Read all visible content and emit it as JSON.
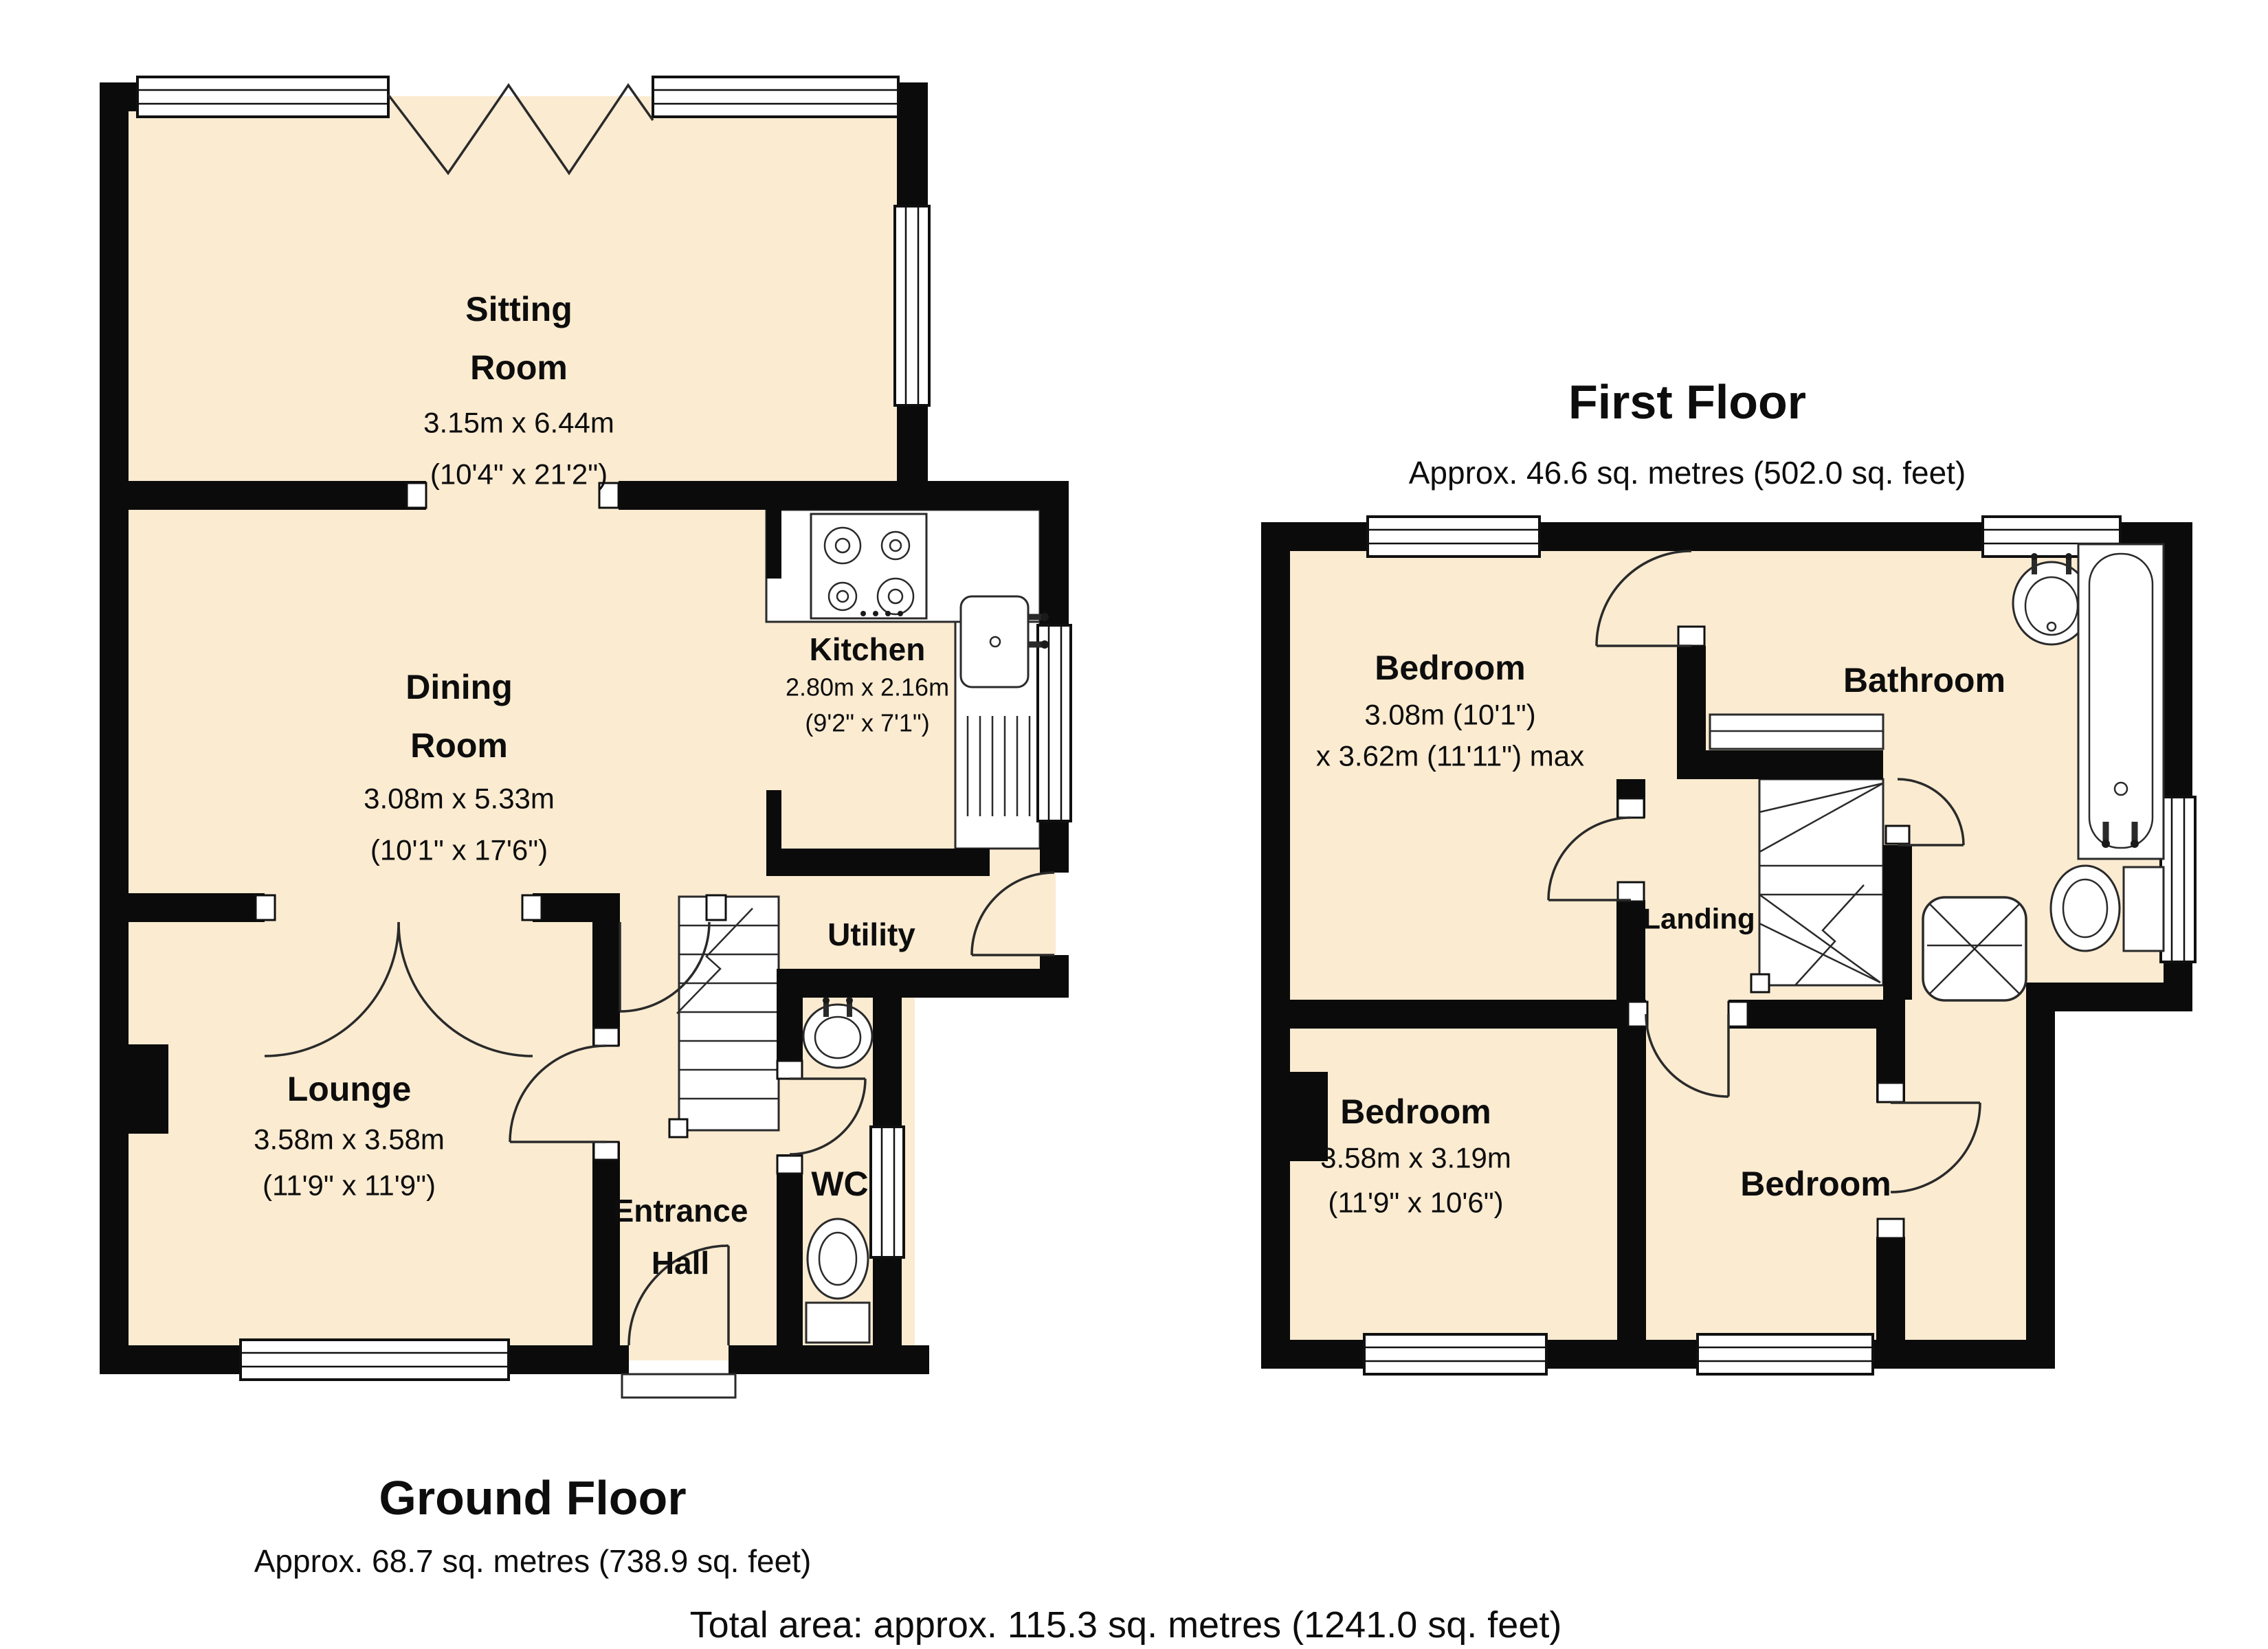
{
  "colors": {
    "wall": "#0b0b0b",
    "room_fill": "#faebd1",
    "fixture_outline": "#2a2a2a",
    "text": "#0d0d0d",
    "background": "#ffffff"
  },
  "ground_floor": {
    "title": "Ground Floor",
    "area": "Approx. 68.7 sq. metres (738.9 sq. feet)",
    "rooms": {
      "sitting": {
        "name_lines": [
          "Sitting",
          "Room"
        ],
        "metric": "3.15m x 6.44m",
        "imperial": "(10'4\" x 21'2\")"
      },
      "dining": {
        "name_lines": [
          "Dining",
          "Room"
        ],
        "metric": "3.08m x 5.33m",
        "imperial": "(10'1\" x 17'6\")"
      },
      "kitchen": {
        "name_lines": [
          "Kitchen"
        ],
        "metric": "2.80m x 2.16m",
        "imperial": "(9'2\" x 7'1\")"
      },
      "lounge": {
        "name_lines": [
          "Lounge"
        ],
        "metric": "3.58m x 3.58m",
        "imperial": "(11'9\" x 11'9\")"
      },
      "utility": {
        "name_lines": [
          "Utility"
        ]
      },
      "hall": {
        "name_lines": [
          "Entrance",
          "Hall"
        ]
      },
      "wc": {
        "name_lines": [
          "WC"
        ]
      }
    }
  },
  "first_floor": {
    "title": "First Floor",
    "area": "Approx. 46.6 sq. metres (502.0 sq. feet)",
    "rooms": {
      "bedroom1": {
        "name_lines": [
          "Bedroom"
        ],
        "metric": "3.08m (10'1\")",
        "imperial": "x 3.62m (11'11\") max"
      },
      "bathroom": {
        "name_lines": [
          "Bathroom"
        ]
      },
      "landing": {
        "name_lines": [
          "Landing"
        ]
      },
      "bedroom2": {
        "name_lines": [
          "Bedroom"
        ],
        "metric": "3.58m x 3.19m",
        "imperial": "(11'9\" x 10'6\")"
      },
      "bedroom3": {
        "name_lines": [
          "Bedroom"
        ]
      }
    }
  },
  "footer": {
    "total": "Total area: approx. 115.3 sq. metres (1241.0 sq. feet)"
  }
}
